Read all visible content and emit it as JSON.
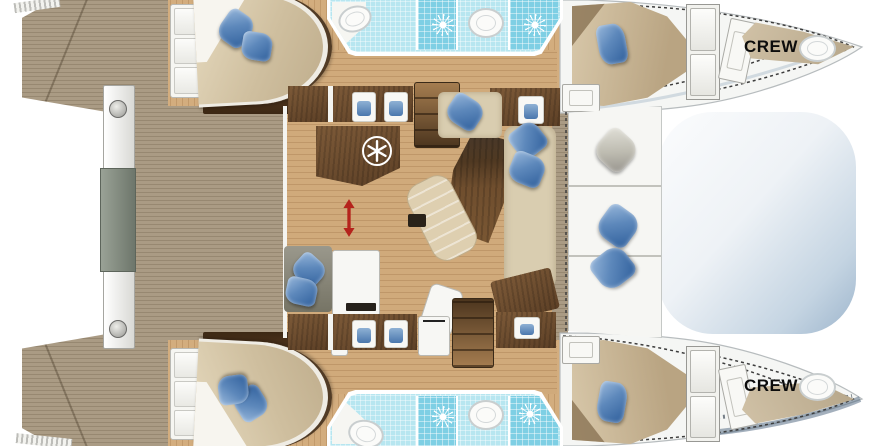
{
  "diagram": {
    "type": "yacht-floor-plan",
    "subject": "catamaran interior layout, top view"
  },
  "labels": {
    "crew_starboard": "CREW",
    "crew_port": "CREW"
  },
  "colors": {
    "background": "#ffffff",
    "teak_deck": "#a99a83",
    "cabin_floor": "#d3ad7e",
    "salon_floor": "#d0aa7b",
    "counter_wood": "#6d4c2e",
    "table_wood": "#5a4128",
    "sofa_beige": "#d9cdb0",
    "bed_duvet": "#d4c5a7",
    "pillow_blue": "#4a77ad",
    "bathroom_tile": "#b7e6f0",
    "shower_tile": "#7ecfe4",
    "fixture_white": "#f7f7f4",
    "trampoline_blue": "#9db5cc",
    "hull_white": "#f5f6f4",
    "arrow_red": "#b5231c",
    "crew_text": "#0c0c0c"
  },
  "icons": {
    "fridge": "snowflake-icon",
    "shower": "shower-sun-icon",
    "sliding_door": "red-double-arrow-icon"
  }
}
